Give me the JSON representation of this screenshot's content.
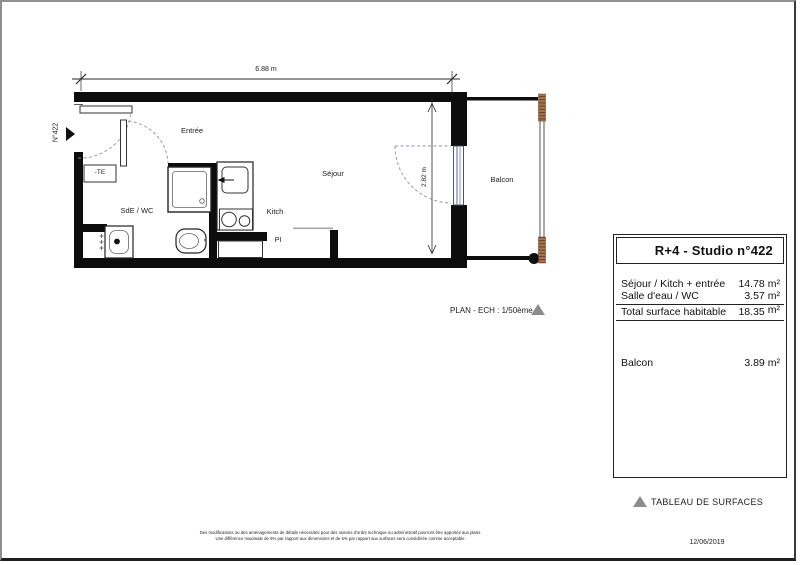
{
  "plan": {
    "unit_label": "N°422",
    "width_dim": "6.88 m",
    "height_dim": "2.82 m",
    "scale_label": "PLAN - ECH : 1/50ème",
    "rooms": {
      "entree": "Entrée",
      "sejour": "Séjour",
      "balcon": "Balcon",
      "sde_wc": "SdE / WC",
      "kitch": "Kitch",
      "pi": "PI",
      "te": "-TE"
    }
  },
  "surface_table": {
    "title": "R+4 - Studio n°422",
    "rows": [
      {
        "label": "Séjour / Kitch + entrée",
        "num": "14.78",
        "unit": "m²"
      },
      {
        "label": "Salle d'eau / WC",
        "num": "3.57",
        "unit": "m²"
      },
      {
        "label": "Total surface habitable",
        "num": "18.35",
        "unit": "m²"
      },
      {
        "label": "Balcon",
        "num": "3.89",
        "unit": "m²"
      }
    ],
    "caption": "TABLEAU DE SURFACES"
  },
  "footer": {
    "date": "12/06/2019",
    "disclaimer_line1": "Des modifications ou des aménagements de détails nécessités pour des raisons d'ordre technique ou administratif pourront être apportés aux plans",
    "disclaimer_line2": "Une différence maximale de 5% par rapport aux dimensions et de 5% par rapport aux surfaces sera considérée comme acceptable"
  },
  "colors": {
    "wall": "#0d0d0d",
    "door_swing": "#8a93ad",
    "window_glass": "#7080b0",
    "railing_wood": "#a8734e",
    "triangle_gray": "#8c8c8c"
  }
}
